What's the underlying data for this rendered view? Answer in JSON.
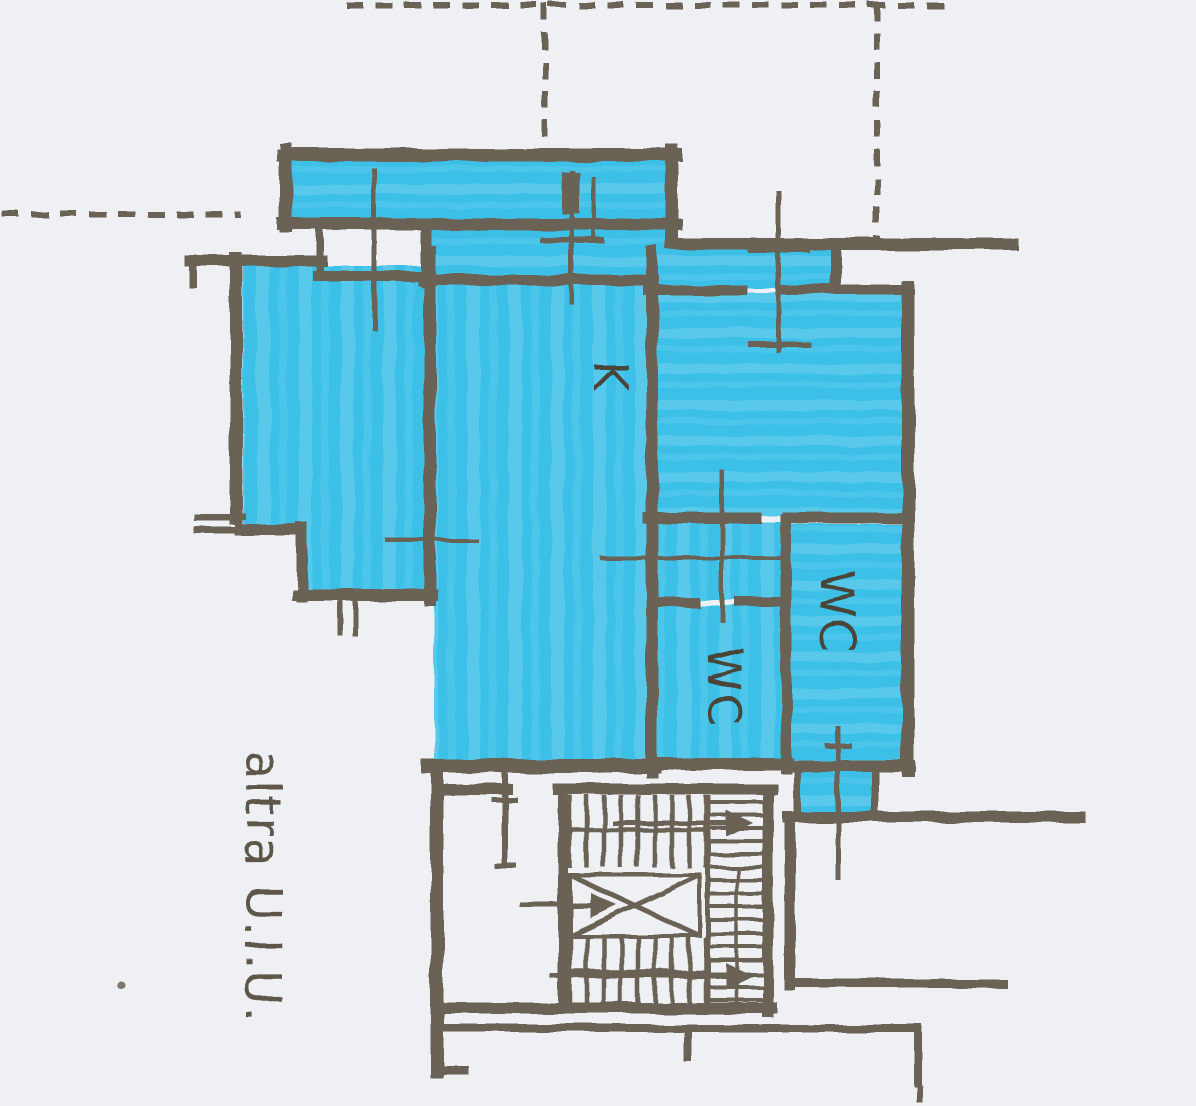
{
  "plan": {
    "labels": {
      "kitchen": "K",
      "wc_center": "WC",
      "wc_right": "WC",
      "adjacent_unit": "altra U.I.U."
    },
    "colors": {
      "paper": "#eef0f4",
      "wall": "#6b6254",
      "highlight": "#3cc0e7",
      "label": "#4a4437",
      "label_secondary": "#5d564a"
    }
  }
}
